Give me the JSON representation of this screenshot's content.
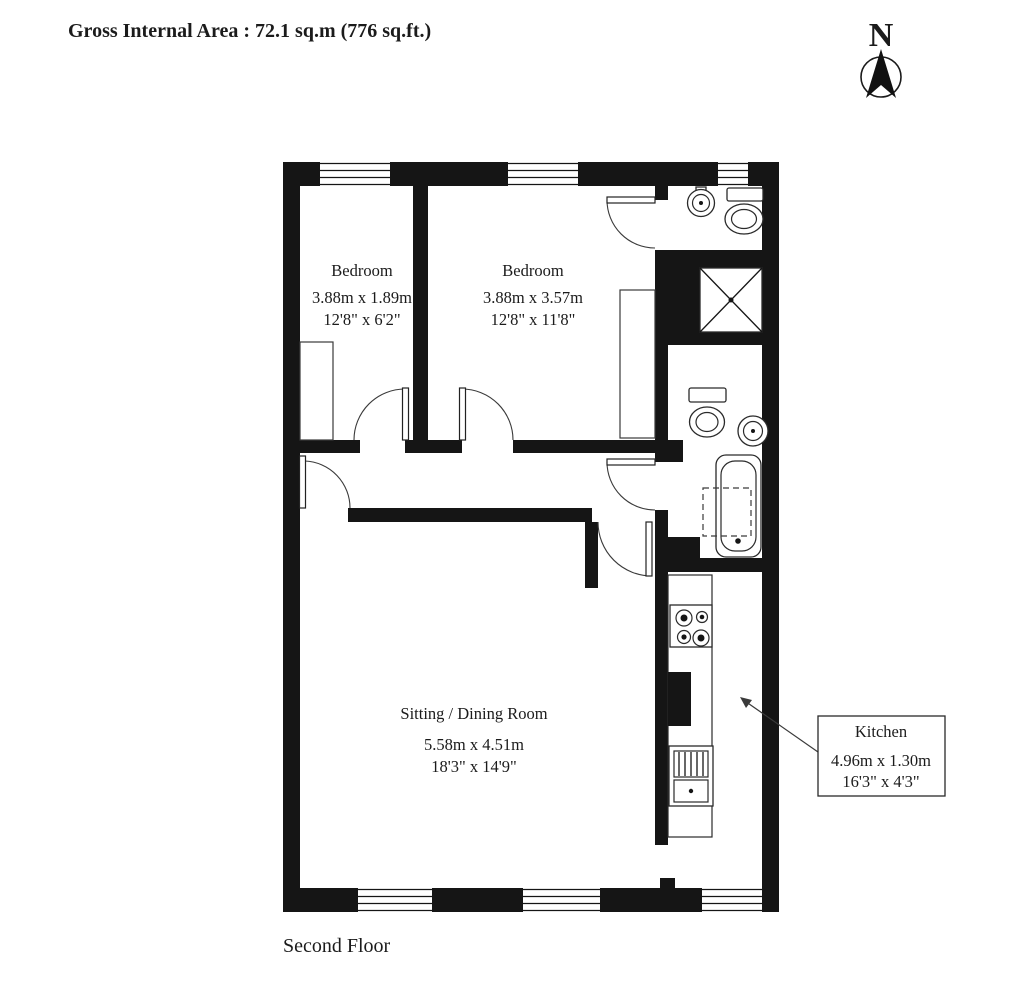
{
  "header": {
    "title": "Gross Internal Area  :  72.1 sq.m  (776 sq.ft.)"
  },
  "compass": {
    "label": "N"
  },
  "rooms": {
    "bedroom1": {
      "name": "Bedroom",
      "dims_m": "3.88m  x  1.89m",
      "dims_ft": "12'8\"  x  6'2\""
    },
    "bedroom2": {
      "name": "Bedroom",
      "dims_m": "3.88m  x  3.57m",
      "dims_ft": "12'8\"  x  11'8\""
    },
    "sitting_dining": {
      "name": "Sitting / Dining Room",
      "dims_m": "5.58m  x  4.51m",
      "dims_ft": "18'3\"  x  14'9\""
    },
    "kitchen": {
      "name": "Kitchen",
      "dims_m": "4.96m  x  1.30m",
      "dims_ft": "16'3\"  x  4'3\""
    }
  },
  "floor_label": "Second Floor",
  "colors": {
    "wall": "#151515",
    "line": "#2a2a2a",
    "background": "#ffffff"
  }
}
